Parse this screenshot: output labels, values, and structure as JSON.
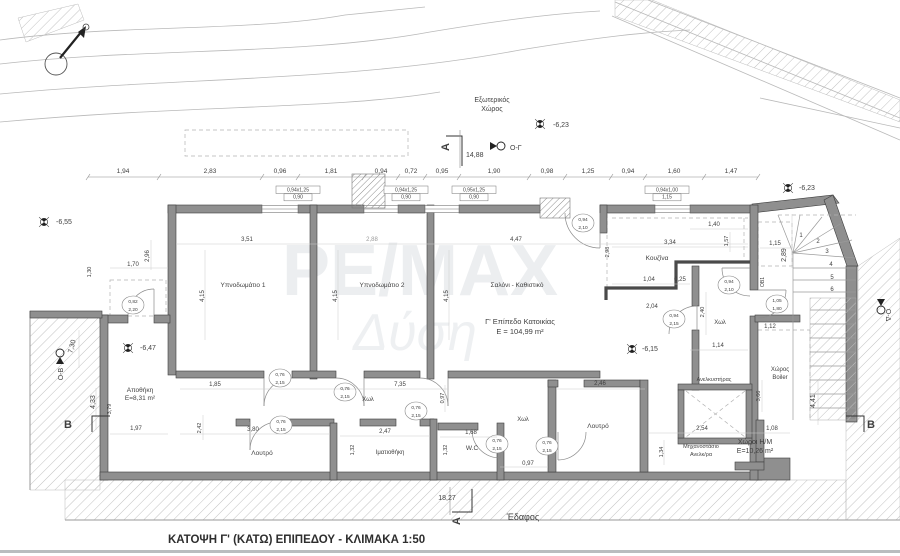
{
  "meta": {
    "title": "ΚΑΤΟΨΗ Γ' (ΚΑΤΩ) ΕΠΙΠΕΔΟΥ  -  ΚΛΙΜΑΚΑ 1:50",
    "drawing_type": "floor-plan",
    "scale": "1:50"
  },
  "watermark": {
    "line1": "ΡΕ/ΜΑΧ",
    "line2": "Δύση"
  },
  "labels_static": {
    "ground": "Έδαφος"
  },
  "texts": [
    {
      "t": "Εξωτερικός",
      "x": 492,
      "y": 102,
      "s": 7,
      "n": "exterior-space-label"
    },
    {
      "t": "Χώρος",
      "x": 492,
      "y": 111,
      "s": 7,
      "n": "exterior-space-label"
    },
    {
      "t": "-6,23",
      "x": 553,
      "y": 127,
      "s": 7,
      "a": "start",
      "n": "level-value"
    },
    {
      "t": "Ο-Γ",
      "x": 510,
      "y": 150,
      "s": 7,
      "a": "start",
      "n": "view-marker-label"
    },
    {
      "t": "14,88",
      "x": 466,
      "y": 157,
      "s": 7,
      "a": "start",
      "n": "dim-total"
    },
    {
      "t": "A",
      "x": 449,
      "y": 147,
      "s": 11,
      "w": 1,
      "r": -90,
      "n": "section-marker-letter"
    },
    {
      "t": "-6,55",
      "x": 56,
      "y": 224,
      "s": 7,
      "a": "start",
      "n": "level-value"
    },
    {
      "t": "-6,23",
      "x": 799,
      "y": 190,
      "s": 7,
      "a": "start",
      "n": "level-value"
    },
    {
      "t": "1,94",
      "x": 123,
      "y": 173,
      "s": 6.5
    },
    {
      "t": "2,83",
      "x": 210,
      "y": 173,
      "s": 6.5
    },
    {
      "t": "0,96",
      "x": 280,
      "y": 173,
      "s": 6.5
    },
    {
      "t": "1,81",
      "x": 331,
      "y": 173,
      "s": 6.5
    },
    {
      "t": "0,94",
      "x": 381,
      "y": 173,
      "s": 6.5
    },
    {
      "t": "0,72",
      "x": 411,
      "y": 173,
      "s": 6.5
    },
    {
      "t": "0,95",
      "x": 442,
      "y": 173,
      "s": 6.5
    },
    {
      "t": "1,90",
      "x": 494,
      "y": 173,
      "s": 6.5
    },
    {
      "t": "0,98",
      "x": 547,
      "y": 173,
      "s": 6.5
    },
    {
      "t": "1,25",
      "x": 588,
      "y": 173,
      "s": 6.5
    },
    {
      "t": "0,94",
      "x": 628,
      "y": 173,
      "s": 6.5
    },
    {
      "t": "1,60",
      "x": 674,
      "y": 173,
      "s": 6.5
    },
    {
      "t": "1,47",
      "x": 731,
      "y": 173,
      "s": 6.5
    },
    {
      "t": "0,94x1,25",
      "x": 298,
      "y": 191.5,
      "s": 5,
      "n": "window-tag"
    },
    {
      "t": "0,90",
      "x": 298,
      "y": 198.5,
      "s": 5,
      "n": "window-tag"
    },
    {
      "t": "0,94x1,25",
      "x": 406,
      "y": 191.5,
      "s": 5,
      "n": "window-tag"
    },
    {
      "t": "0,90",
      "x": 406,
      "y": 198.5,
      "s": 5,
      "n": "window-tag"
    },
    {
      "t": "0,95x1,25",
      "x": 474,
      "y": 191.5,
      "s": 5,
      "n": "window-tag"
    },
    {
      "t": "0,90",
      "x": 474,
      "y": 198.5,
      "s": 5,
      "n": "window-tag"
    },
    {
      "t": "0,94x1,00",
      "x": 667,
      "y": 191.5,
      "s": 5,
      "n": "window-tag"
    },
    {
      "t": "1,15",
      "x": 667,
      "y": 198.5,
      "s": 5,
      "n": "window-tag"
    },
    {
      "t": "2,96",
      "x": 149,
      "y": 256,
      "r": -90,
      "s": 6
    },
    {
      "t": "1,70",
      "x": 133,
      "y": 266,
      "s": 6
    },
    {
      "t": "1,30",
      "x": 91,
      "y": 272,
      "r": -90,
      "s": 5.5
    },
    {
      "t": "7,30",
      "x": 74,
      "y": 347,
      "r": -75,
      "s": 7
    },
    {
      "t": "Ο-Β",
      "x": 63,
      "y": 374,
      "r": -90,
      "s": 7,
      "n": "view-marker-label"
    },
    {
      "t": "4,33",
      "x": 95,
      "y": 402,
      "r": -90,
      "s": 7
    },
    {
      "t": "3,79",
      "x": 111,
      "y": 409,
      "r": -90,
      "s": 5.5
    },
    {
      "t": "-6,47",
      "x": 140,
      "y": 350,
      "s": 7,
      "a": "start",
      "n": "level-value"
    },
    {
      "t": "Αποθήκη",
      "x": 140,
      "y": 392,
      "s": 6.5,
      "n": "room-label-storage"
    },
    {
      "t": "Ε=8,31 m²",
      "x": 140,
      "y": 400,
      "s": 6.5,
      "n": "room-area-storage"
    },
    {
      "t": "1,97",
      "x": 136,
      "y": 430,
      "s": 6
    },
    {
      "t": "B",
      "x": 68,
      "y": 428,
      "s": 11,
      "w": 1,
      "n": "section-marker-letter"
    },
    {
      "t": "3,51",
      "x": 247,
      "y": 241,
      "s": 6
    },
    {
      "t": "2,88",
      "x": 372,
      "y": 241,
      "s": 6,
      "c": "#9a9a9a"
    },
    {
      "t": "4,47",
      "x": 516,
      "y": 241,
      "s": 6
    },
    {
      "t": "4,15",
      "x": 204,
      "y": 296,
      "r": -90,
      "s": 6
    },
    {
      "t": "4,15",
      "x": 337,
      "y": 296,
      "r": -90,
      "s": 6
    },
    {
      "t": "4,15",
      "x": 448,
      "y": 296,
      "r": -90,
      "s": 6
    },
    {
      "t": "Υπνοδωμάτιο 1",
      "x": 243,
      "y": 287,
      "s": 6.5,
      "n": "room-label-bedroom-1"
    },
    {
      "t": "Υπνοδωμάτιο 2",
      "x": 382,
      "y": 287,
      "s": 6.5,
      "n": "room-label-bedroom-2"
    },
    {
      "t": "Σαλόνι - Καθιστικό",
      "x": 517,
      "y": 287,
      "s": 6.5,
      "n": "room-label-living"
    },
    {
      "t": "Γ' Επίπεδο Κατοικίας",
      "x": 520,
      "y": 324,
      "s": 7.5,
      "n": "floor-level-label"
    },
    {
      "t": "Ε = 104,99 m²",
      "x": 520,
      "y": 334,
      "s": 7.5,
      "n": "floor-area-label"
    },
    {
      "t": "Κουζίνα",
      "x": 657,
      "y": 260,
      "s": 6.5,
      "n": "room-label-kitchen"
    },
    {
      "t": "2,98",
      "x": 609,
      "y": 252,
      "r": -90,
      "s": 5.5
    },
    {
      "t": "3,34",
      "x": 670,
      "y": 244,
      "s": 6
    },
    {
      "t": "1,40",
      "x": 714,
      "y": 226,
      "s": 6
    },
    {
      "t": "1,57",
      "x": 728,
      "y": 241,
      "r": -90,
      "s": 5.5
    },
    {
      "t": "1,04",
      "x": 649,
      "y": 281,
      "s": 6
    },
    {
      "t": "0,25",
      "x": 680,
      "y": 281,
      "s": 6
    },
    {
      "t": "2,04",
      "x": 652,
      "y": 308,
      "s": 6
    },
    {
      "t": "2,40",
      "x": 704,
      "y": 312,
      "r": -90,
      "s": 5.5
    },
    {
      "t": "1,14",
      "x": 718,
      "y": 347,
      "s": 6
    },
    {
      "t": "-6,15",
      "x": 642,
      "y": 351,
      "s": 7,
      "a": "start",
      "n": "level-value"
    },
    {
      "t": "Χωλ",
      "x": 720,
      "y": 324,
      "s": 6,
      "n": "room-label-hall"
    },
    {
      "t": "1,15",
      "x": 775,
      "y": 245,
      "s": 6
    },
    {
      "t": "2,89",
      "x": 786,
      "y": 255,
      "r": -90,
      "s": 7
    },
    {
      "t": "ΟΒ1",
      "x": 764,
      "y": 282,
      "r": -90,
      "s": 5
    },
    {
      "t": "1,12",
      "x": 770,
      "y": 328,
      "s": 6
    },
    {
      "t": "Χώρος",
      "x": 780,
      "y": 371,
      "s": 6,
      "n": "room-label-boiler"
    },
    {
      "t": "Boiler",
      "x": 780,
      "y": 379,
      "s": 6,
      "n": "room-label-boiler"
    },
    {
      "t": "Ο-Δ",
      "x": 886,
      "y": 315,
      "r": 90,
      "s": 7,
      "n": "view-marker-label"
    },
    {
      "t": "1",
      "x": 801,
      "y": 237,
      "s": 6,
      "n": "stair-step-number"
    },
    {
      "t": "2",
      "x": 818,
      "y": 243,
      "s": 6,
      "n": "stair-step-number"
    },
    {
      "t": "3",
      "x": 827,
      "y": 253,
      "s": 6,
      "n": "stair-step-number"
    },
    {
      "t": "4",
      "x": 831,
      "y": 266,
      "s": 6,
      "n": "stair-step-number"
    },
    {
      "t": "5",
      "x": 832,
      "y": 279,
      "s": 6,
      "n": "stair-step-number"
    },
    {
      "t": "6",
      "x": 832,
      "y": 291,
      "s": 6,
      "n": "stair-step-number"
    },
    {
      "t": "0,94",
      "x": 583,
      "y": 221,
      "s": 4.8,
      "n": "door-tag"
    },
    {
      "t": "2,10",
      "x": 583,
      "y": 229,
      "s": 4.8,
      "n": "door-tag"
    },
    {
      "t": "0,82",
      "x": 133,
      "y": 303,
      "s": 4.8,
      "n": "door-tag"
    },
    {
      "t": "2,20",
      "x": 133,
      "y": 311,
      "s": 4.8,
      "n": "door-tag"
    },
    {
      "t": "0,76",
      "x": 280,
      "y": 376,
      "s": 4.8,
      "n": "door-tag"
    },
    {
      "t": "2,15",
      "x": 280,
      "y": 384,
      "s": 4.8,
      "n": "door-tag"
    },
    {
      "t": "0,76",
      "x": 345,
      "y": 390,
      "s": 4.8,
      "n": "door-tag"
    },
    {
      "t": "2,15",
      "x": 345,
      "y": 398,
      "s": 4.8,
      "n": "door-tag"
    },
    {
      "t": "0,76",
      "x": 416,
      "y": 409,
      "s": 4.8,
      "n": "door-tag"
    },
    {
      "t": "2,15",
      "x": 416,
      "y": 417,
      "s": 4.8,
      "n": "door-tag"
    },
    {
      "t": "0,76",
      "x": 281,
      "y": 423,
      "s": 4.8,
      "n": "door-tag"
    },
    {
      "t": "2,15",
      "x": 281,
      "y": 431,
      "s": 4.8,
      "n": "door-tag"
    },
    {
      "t": "0,76",
      "x": 497,
      "y": 442,
      "s": 4.8,
      "n": "door-tag"
    },
    {
      "t": "2,15",
      "x": 497,
      "y": 450,
      "s": 4.8,
      "n": "door-tag"
    },
    {
      "t": "0,76",
      "x": 547,
      "y": 444,
      "s": 4.8,
      "n": "door-tag"
    },
    {
      "t": "2,15",
      "x": 547,
      "y": 452,
      "s": 4.8,
      "n": "door-tag"
    },
    {
      "t": "0,94",
      "x": 729,
      "y": 283,
      "s": 4.8,
      "n": "door-tag"
    },
    {
      "t": "2,10",
      "x": 729,
      "y": 291,
      "s": 4.8,
      "n": "door-tag"
    },
    {
      "t": "0,94",
      "x": 674,
      "y": 317,
      "s": 4.8,
      "n": "door-tag"
    },
    {
      "t": "2,15",
      "x": 674,
      "y": 325,
      "s": 4.8,
      "n": "door-tag"
    },
    {
      "t": "1,05",
      "x": 777,
      "y": 302,
      "s": 4.8,
      "n": "door-tag"
    },
    {
      "t": "1,80",
      "x": 777,
      "y": 310,
      "s": 4.8,
      "n": "door-tag"
    },
    {
      "t": "1,85",
      "x": 215,
      "y": 386,
      "s": 6
    },
    {
      "t": "7,35",
      "x": 400,
      "y": 386,
      "s": 6
    },
    {
      "t": "Χωλ",
      "x": 368,
      "y": 401,
      "s": 6,
      "n": "room-label-hall"
    },
    {
      "t": "0,97",
      "x": 444,
      "y": 398,
      "r": -90,
      "s": 5.5
    },
    {
      "t": "2,42",
      "x": 201,
      "y": 428,
      "r": -90,
      "s": 5.5
    },
    {
      "t": "3,80",
      "x": 253,
      "y": 431,
      "s": 6
    },
    {
      "t": "2,47",
      "x": 385,
      "y": 433,
      "s": 6
    },
    {
      "t": "1,32",
      "x": 354,
      "y": 450,
      "r": -90,
      "s": 5.5
    },
    {
      "t": "1,68",
      "x": 471,
      "y": 434,
      "s": 6
    },
    {
      "t": "1,32",
      "x": 447,
      "y": 450,
      "r": -90,
      "s": 5.5
    },
    {
      "t": "W.C",
      "x": 472,
      "y": 450,
      "s": 6.5,
      "n": "room-label-wc"
    },
    {
      "t": "Λουτρό",
      "x": 262,
      "y": 455,
      "s": 6.5,
      "n": "room-label-bath-1"
    },
    {
      "t": "Ιματιοθήκη",
      "x": 390,
      "y": 454,
      "s": 6,
      "n": "room-label-closet"
    },
    {
      "t": "Χωλ",
      "x": 523,
      "y": 421,
      "s": 6,
      "n": "room-label-hall"
    },
    {
      "t": "2,46",
      "x": 600,
      "y": 385,
      "s": 6
    },
    {
      "t": "Λουτρό",
      "x": 598,
      "y": 428,
      "s": 6.5,
      "n": "room-label-bath-2"
    },
    {
      "t": "0,97",
      "x": 528,
      "y": 465,
      "s": 6
    },
    {
      "t": "Ανελκυστήρας",
      "x": 714,
      "y": 381,
      "s": 5.5,
      "n": "room-label-elevator"
    },
    {
      "t": "2,54",
      "x": 702,
      "y": 430,
      "s": 6
    },
    {
      "t": "1,08",
      "x": 772,
      "y": 430,
      "s": 6
    },
    {
      "t": "1,34",
      "x": 663,
      "y": 452,
      "r": -90,
      "s": 5.5
    },
    {
      "t": "Μηχανοστάσιο",
      "x": 701,
      "y": 448,
      "s": 5.5,
      "n": "room-label-machine-room"
    },
    {
      "t": "Ανελκ/ρα",
      "x": 701,
      "y": 456,
      "s": 5.5,
      "n": "room-label-machine-room"
    },
    {
      "t": "Χώροι Η/Μ",
      "x": 755,
      "y": 444,
      "s": 7,
      "n": "room-label-mep"
    },
    {
      "t": "Ε=10,26 m²",
      "x": 755,
      "y": 453,
      "s": 7,
      "n": "room-area-mep"
    },
    {
      "t": "3,66",
      "x": 760,
      "y": 396,
      "r": -90,
      "s": 5.5
    },
    {
      "t": "4,41",
      "x": 815,
      "y": 401,
      "r": -90,
      "s": 7
    },
    {
      "t": "18,27",
      "x": 447,
      "y": 500,
      "s": 7
    },
    {
      "t": "A",
      "x": 460,
      "y": 521,
      "s": 11,
      "w": 1,
      "r": -90,
      "n": "section-marker-letter"
    },
    {
      "t": "B",
      "x": 871,
      "y": 428,
      "s": 11,
      "w": 1,
      "n": "section-marker-letter"
    }
  ]
}
